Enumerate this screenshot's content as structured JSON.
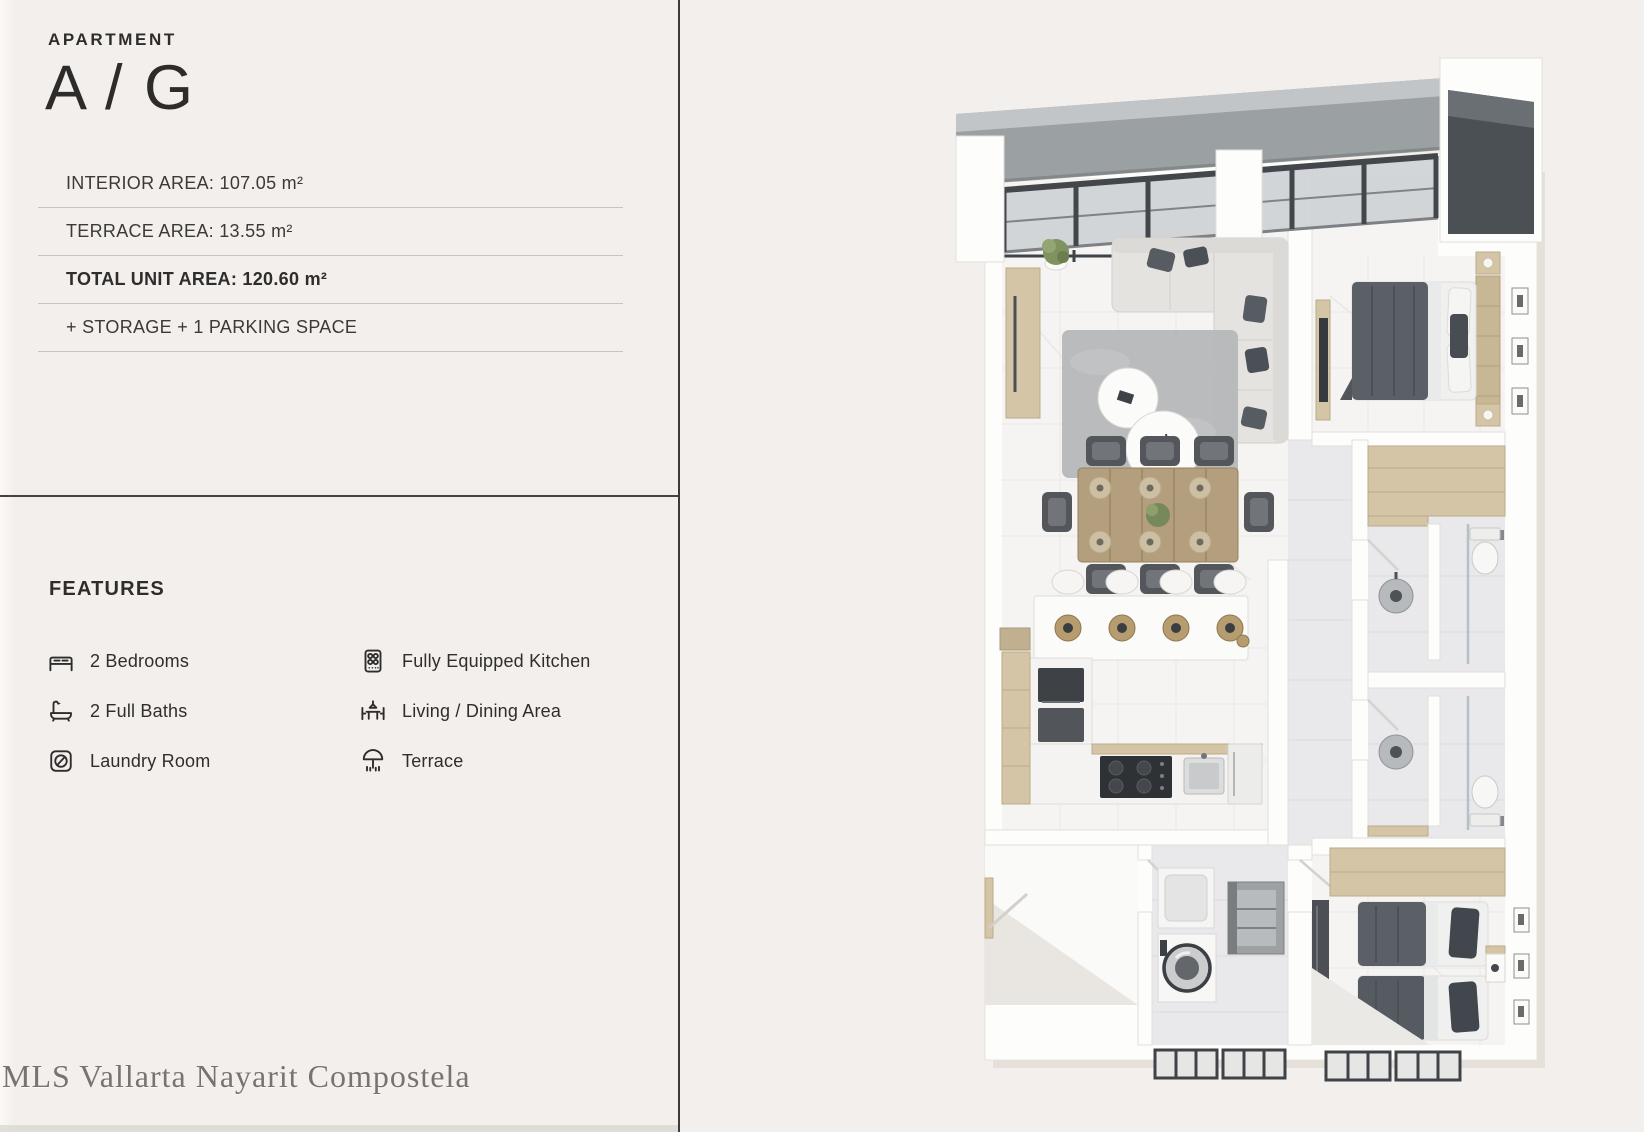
{
  "palette": {
    "background": "#f3efec",
    "divider_line": "#3e3b38",
    "text": "#2f2e2c",
    "rule_line": "#c7c3bf",
    "wood_accent": "#d3c5a6",
    "dark_fixture": "#4c5056",
    "pergola_glass": "#ccd0d3",
    "watermark_gray": "#777370"
  },
  "header": {
    "label": "APARTMENT",
    "title": "A / G"
  },
  "specs": {
    "rows": [
      {
        "text": "INTERIOR AREA: 107.05 m²",
        "emphasis": false
      },
      {
        "text": "TERRACE AREA: 13.55 m²",
        "emphasis": false
      },
      {
        "text": "TOTAL UNIT AREA: 120.60 m²",
        "emphasis": true
      },
      {
        "text": "+ STORAGE + 1 PARKING SPACE",
        "emphasis": false
      }
    ]
  },
  "features": {
    "title": "FEATURES",
    "items": [
      {
        "icon": "bed-icon",
        "label": "2 Bedrooms"
      },
      {
        "icon": "bathtub-icon",
        "label": "2 Full Baths"
      },
      {
        "icon": "laundry-icon",
        "label": "Laundry Room"
      },
      {
        "icon": "stove-icon",
        "label": "Fully Equipped Kitchen"
      },
      {
        "icon": "dining-icon",
        "label": "Living / Dining Area"
      },
      {
        "icon": "terrace-icon",
        "label": "Terrace"
      }
    ]
  },
  "watermark": {
    "text": "MLS Vallarta Nayarit Compostela"
  },
  "floor_plan": {
    "type": "3d-render-top-view",
    "rooms": [
      "Terrace with pergola",
      "Living / Dining",
      "Kitchen",
      "Master Bedroom",
      "Bathroom 1",
      "Bathroom 2",
      "Hallway",
      "Laundry Room",
      "Second Bedroom",
      "Entry Foyer"
    ]
  }
}
